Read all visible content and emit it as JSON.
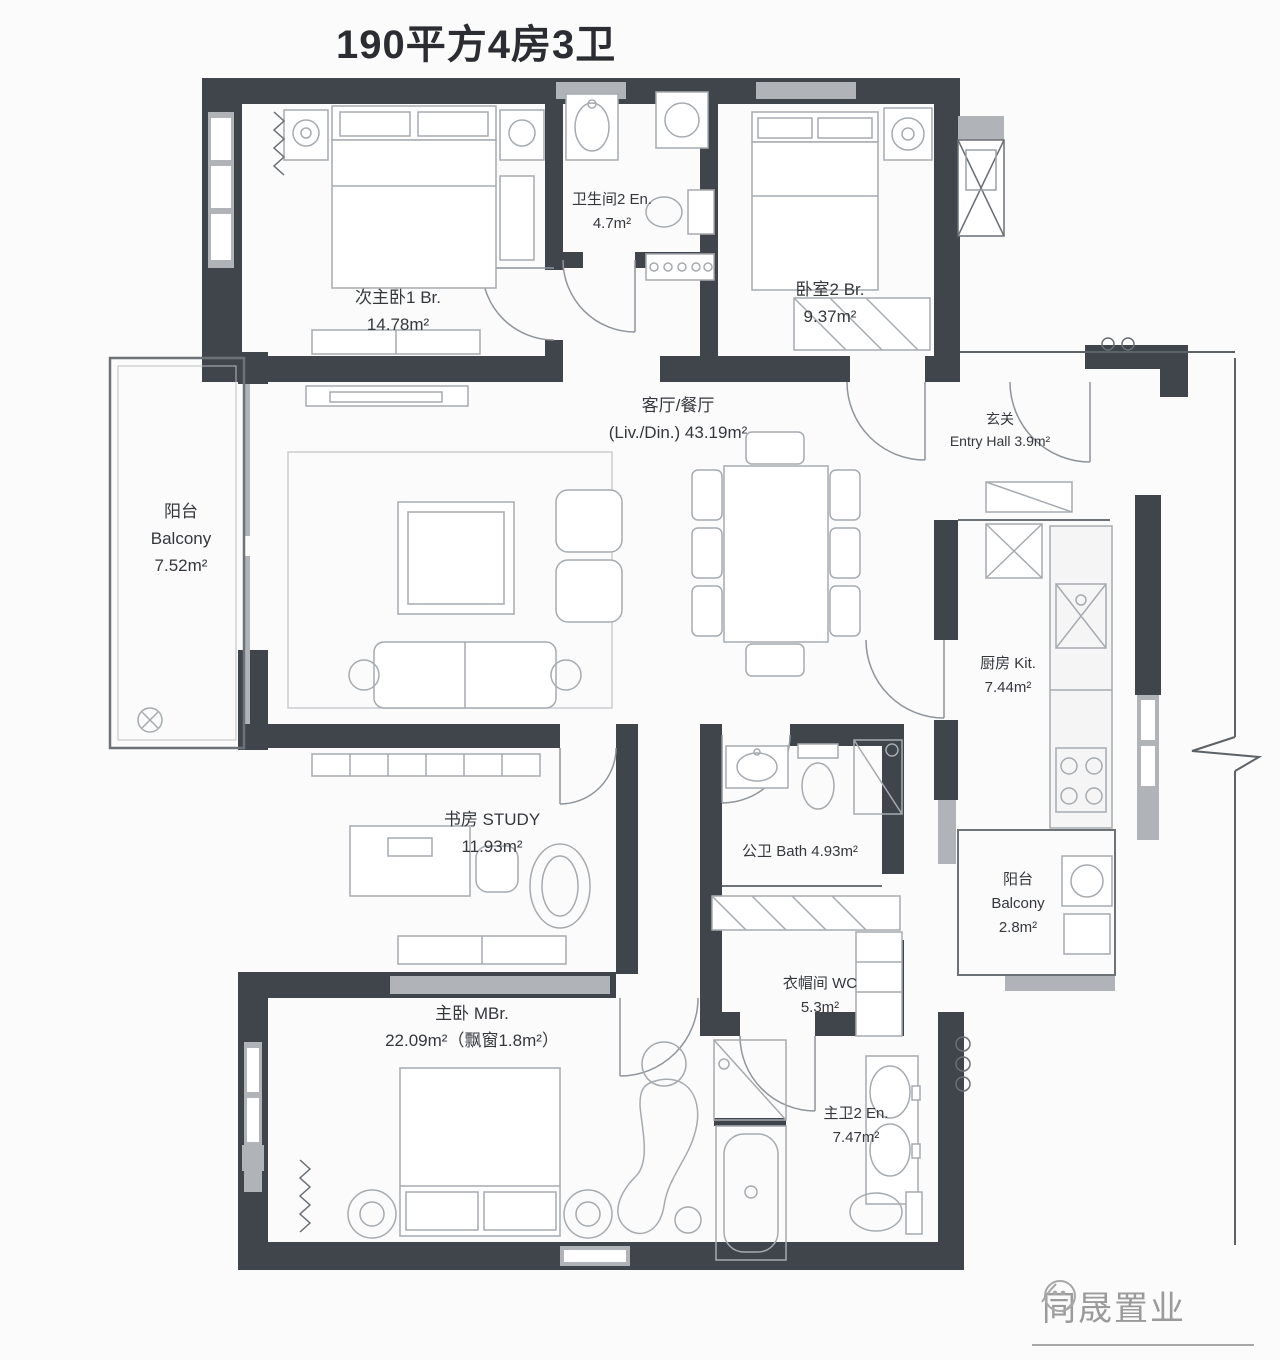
{
  "title": "190平方4房3卫",
  "logo": {
    "text": "同晟置业",
    "icon": "sketch-globe-icon"
  },
  "rooms": {
    "bedroom1": {
      "name": "次主卧1 Br.",
      "area": "14.78m²"
    },
    "bath2": {
      "name": "卫生间2 En.",
      "area": "4.7m²"
    },
    "bedroom2": {
      "name": "卧室2 Br.",
      "area": "9.37m²"
    },
    "living": {
      "name": "客厅/餐厅",
      "area": "(Liv./Din.) 43.19m²"
    },
    "entry": {
      "name": "玄关",
      "area": "Entry Hall 3.9m²"
    },
    "balcony_left": {
      "name": "阳台",
      "name_en": "Balcony",
      "area": "7.52m²"
    },
    "kitchen": {
      "name": "厨房 Kit.",
      "area": "7.44m²"
    },
    "study": {
      "name": "书房 STUDY",
      "area": "11.93m²"
    },
    "bath_public": {
      "name": "公卫 Bath 4.93m²"
    },
    "balcony_right": {
      "name": "阳台",
      "name_en": "Balcony",
      "area": "2.8m²"
    },
    "cloakroom": {
      "name": "衣帽间 WC",
      "area": "5.3m²"
    },
    "master": {
      "name": "主卧 MBr.",
      "area": "22.09m²（飘窗1.8m²）"
    },
    "bath_master": {
      "name": "主卫2 En.",
      "area": "7.47m²"
    }
  },
  "colors": {
    "wall": "#40454c",
    "window": "#b0b4b9",
    "line": "#8f959b",
    "text": "#34373c"
  }
}
